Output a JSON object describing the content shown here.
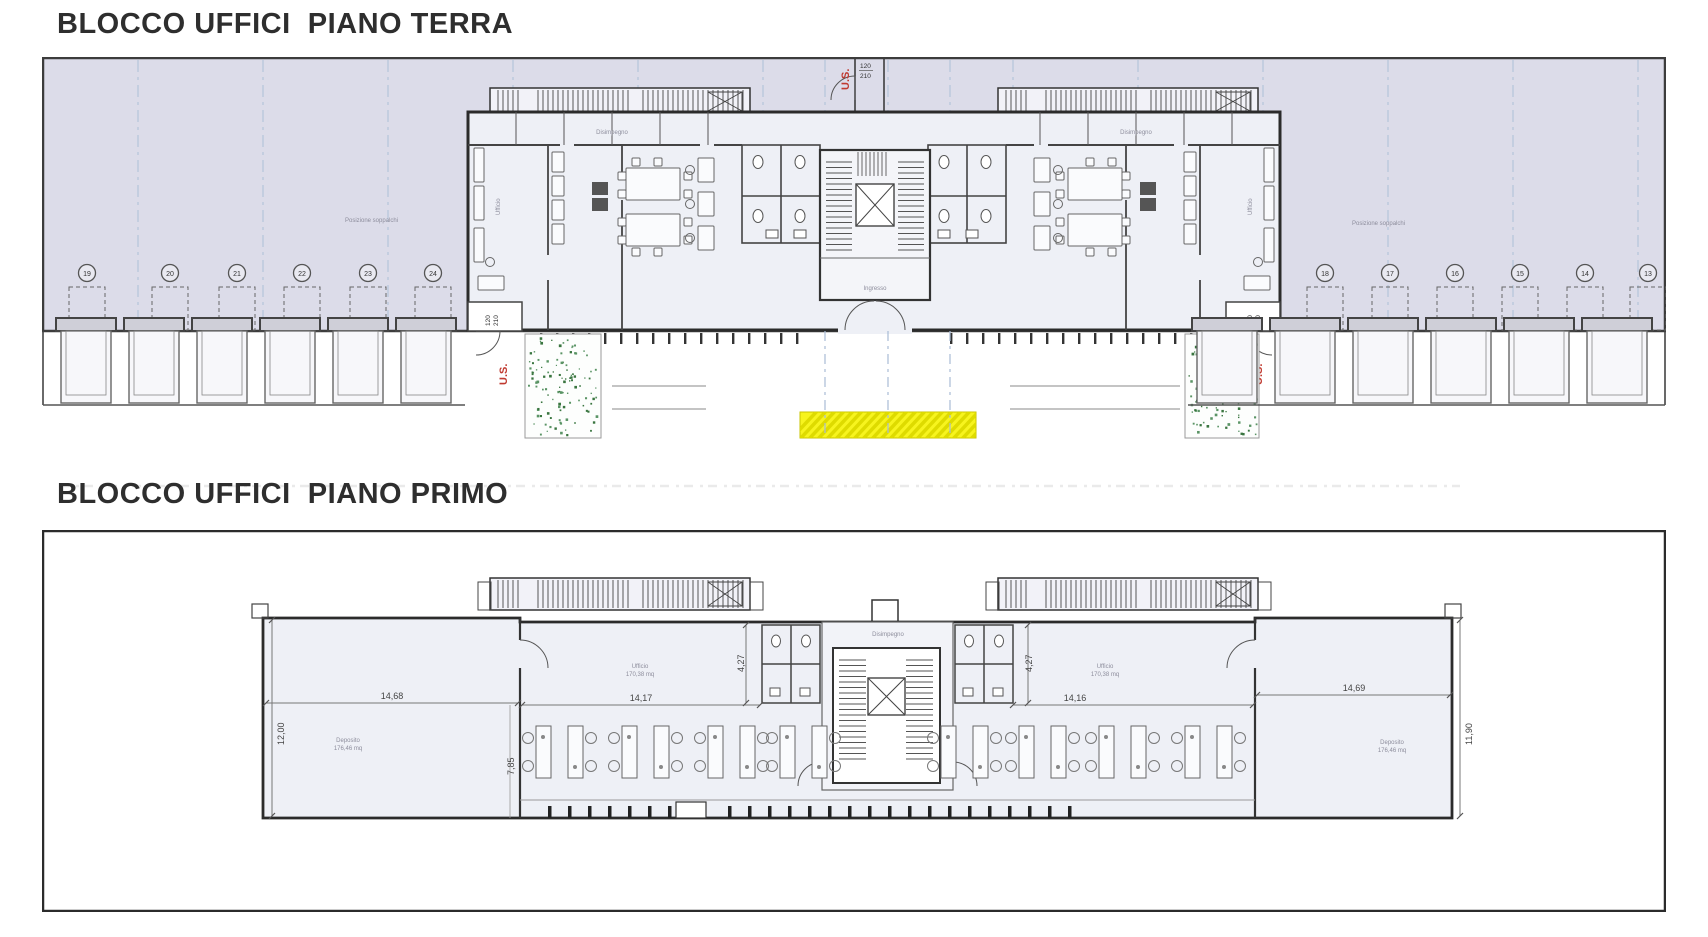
{
  "titles": {
    "plan1": "BLOCCO UFFICI  PIANO TERRA",
    "plan2": "BLOCCO UFFICI  PIANO PRIMO"
  },
  "annotations": {
    "exit_label": "U.S.",
    "door_width": "120",
    "door_height": "210",
    "wing_note": "Posizione soppalchi",
    "room_office": "Ufficio",
    "room_hall": "Disimpegno",
    "room_entry": "Ingresso",
    "room_storage": "Deposito",
    "office_area": "170,38 mq",
    "storage_area": "176,46 mq"
  },
  "parking": {
    "left_numbers": [
      "19",
      "20",
      "21",
      "22",
      "23",
      "24"
    ],
    "right_numbers": [
      "18",
      "17",
      "16",
      "15",
      "14",
      "13"
    ]
  },
  "dimensions": {
    "wing_left": "14,68",
    "wing_left_v": "12,00",
    "office_left": "14,17",
    "office_left_v": "7,85",
    "bath_left": "4,27",
    "bath_right": "4,27",
    "office_right": "14,16",
    "wing_right": "14,69",
    "wing_right_v": "11,90"
  },
  "colors": {
    "site_band": "#dcdce9",
    "building_interior": "#eef0f6",
    "wall": "#2b2b2b",
    "grid_blue": "#a9bcd6",
    "exit_red": "#c03a30",
    "highlight_yellow": "#f7f41e",
    "planting_green": "#39753f"
  }
}
